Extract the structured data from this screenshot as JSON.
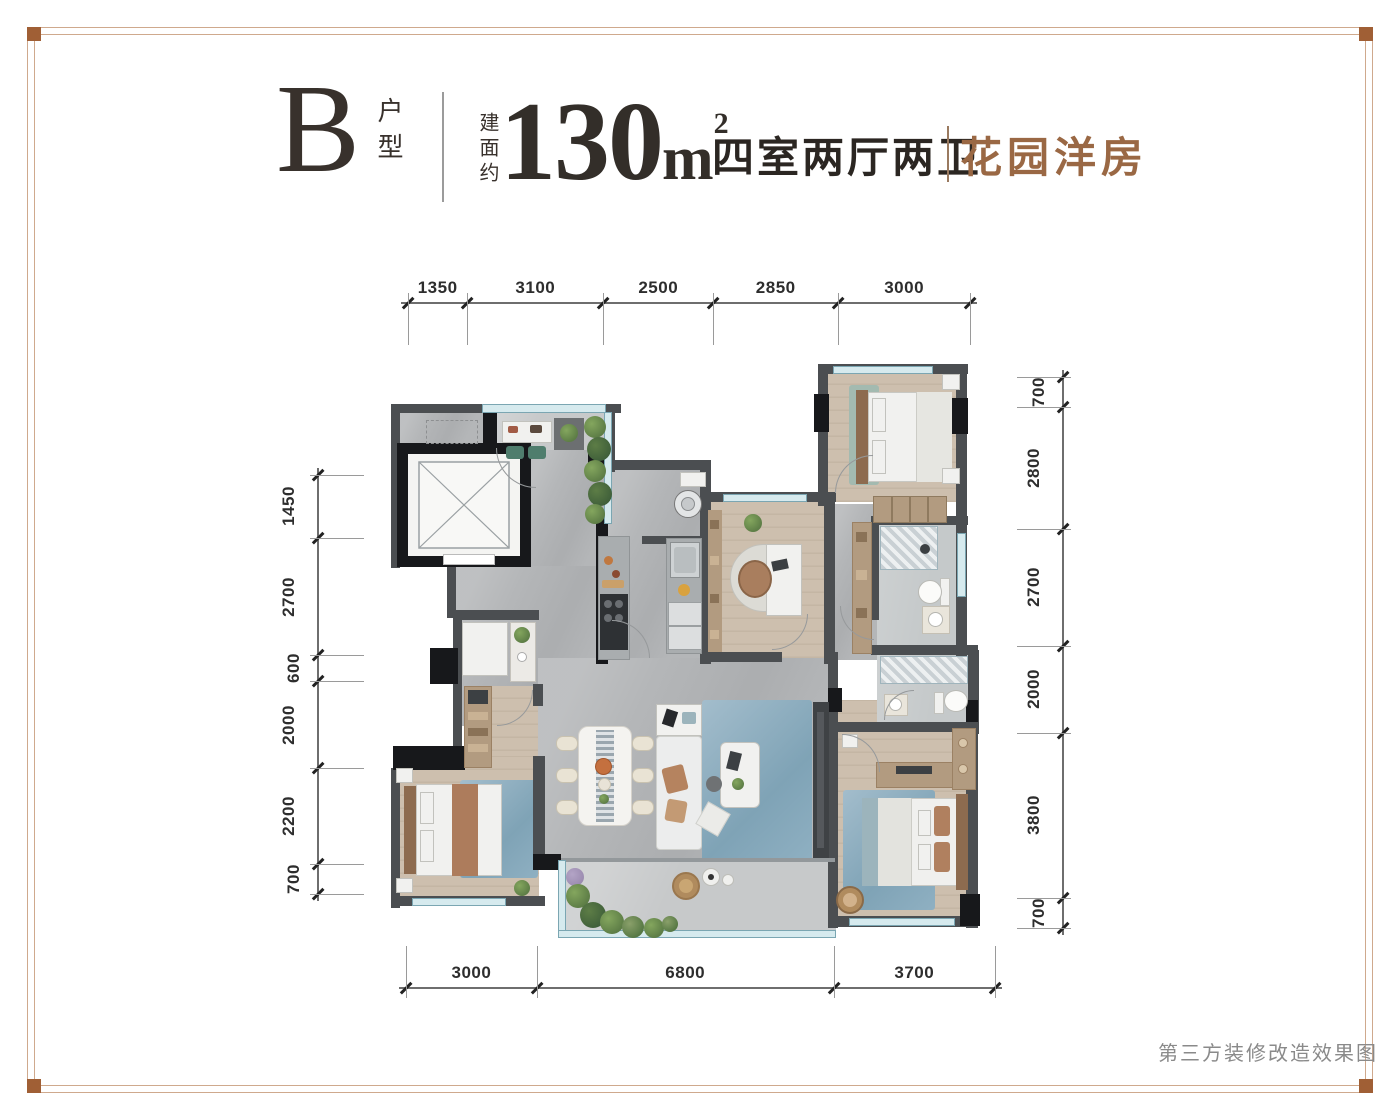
{
  "header": {
    "unit_letter": "B",
    "unit_label": "户型",
    "area_prefix": "建面约",
    "area_value": "130",
    "area_unit": "m",
    "area_sup": "2",
    "rooms_text": "四室两厅两卫",
    "tag_text": "花园洋房"
  },
  "caption": "第三方装修改造效果图",
  "dimensions": {
    "top": [
      "1350",
      "3100",
      "2500",
      "2850",
      "3000"
    ],
    "bottom": [
      "3000",
      "6800",
      "3700"
    ],
    "left": [
      "1450",
      "2700",
      "600",
      "2000",
      "2200",
      "700"
    ],
    "right": [
      "700",
      "2800",
      "2700",
      "2000",
      "3800",
      "700"
    ]
  },
  "colors": {
    "accent_brown": "#9a6844",
    "frame_line": "#cfa98d",
    "frame_corner": "#a05f35",
    "title_dark": "#38312c",
    "dim_text": "#2d2d2d",
    "caption_gray": "#8a8a8a",
    "wall": "#4b4e51",
    "wall_black": "#17181b",
    "window": "#d6eaee",
    "window_border": "#7ba6b2",
    "tile": "#b4b6b8",
    "tile_light": "#c7c9ca",
    "wood": "#cdbfae",
    "wood_dark": "#b29b80",
    "rug_blue": "#8fb0c2",
    "plant": "#5d7d46",
    "white_furn": "#f1f1ef"
  }
}
